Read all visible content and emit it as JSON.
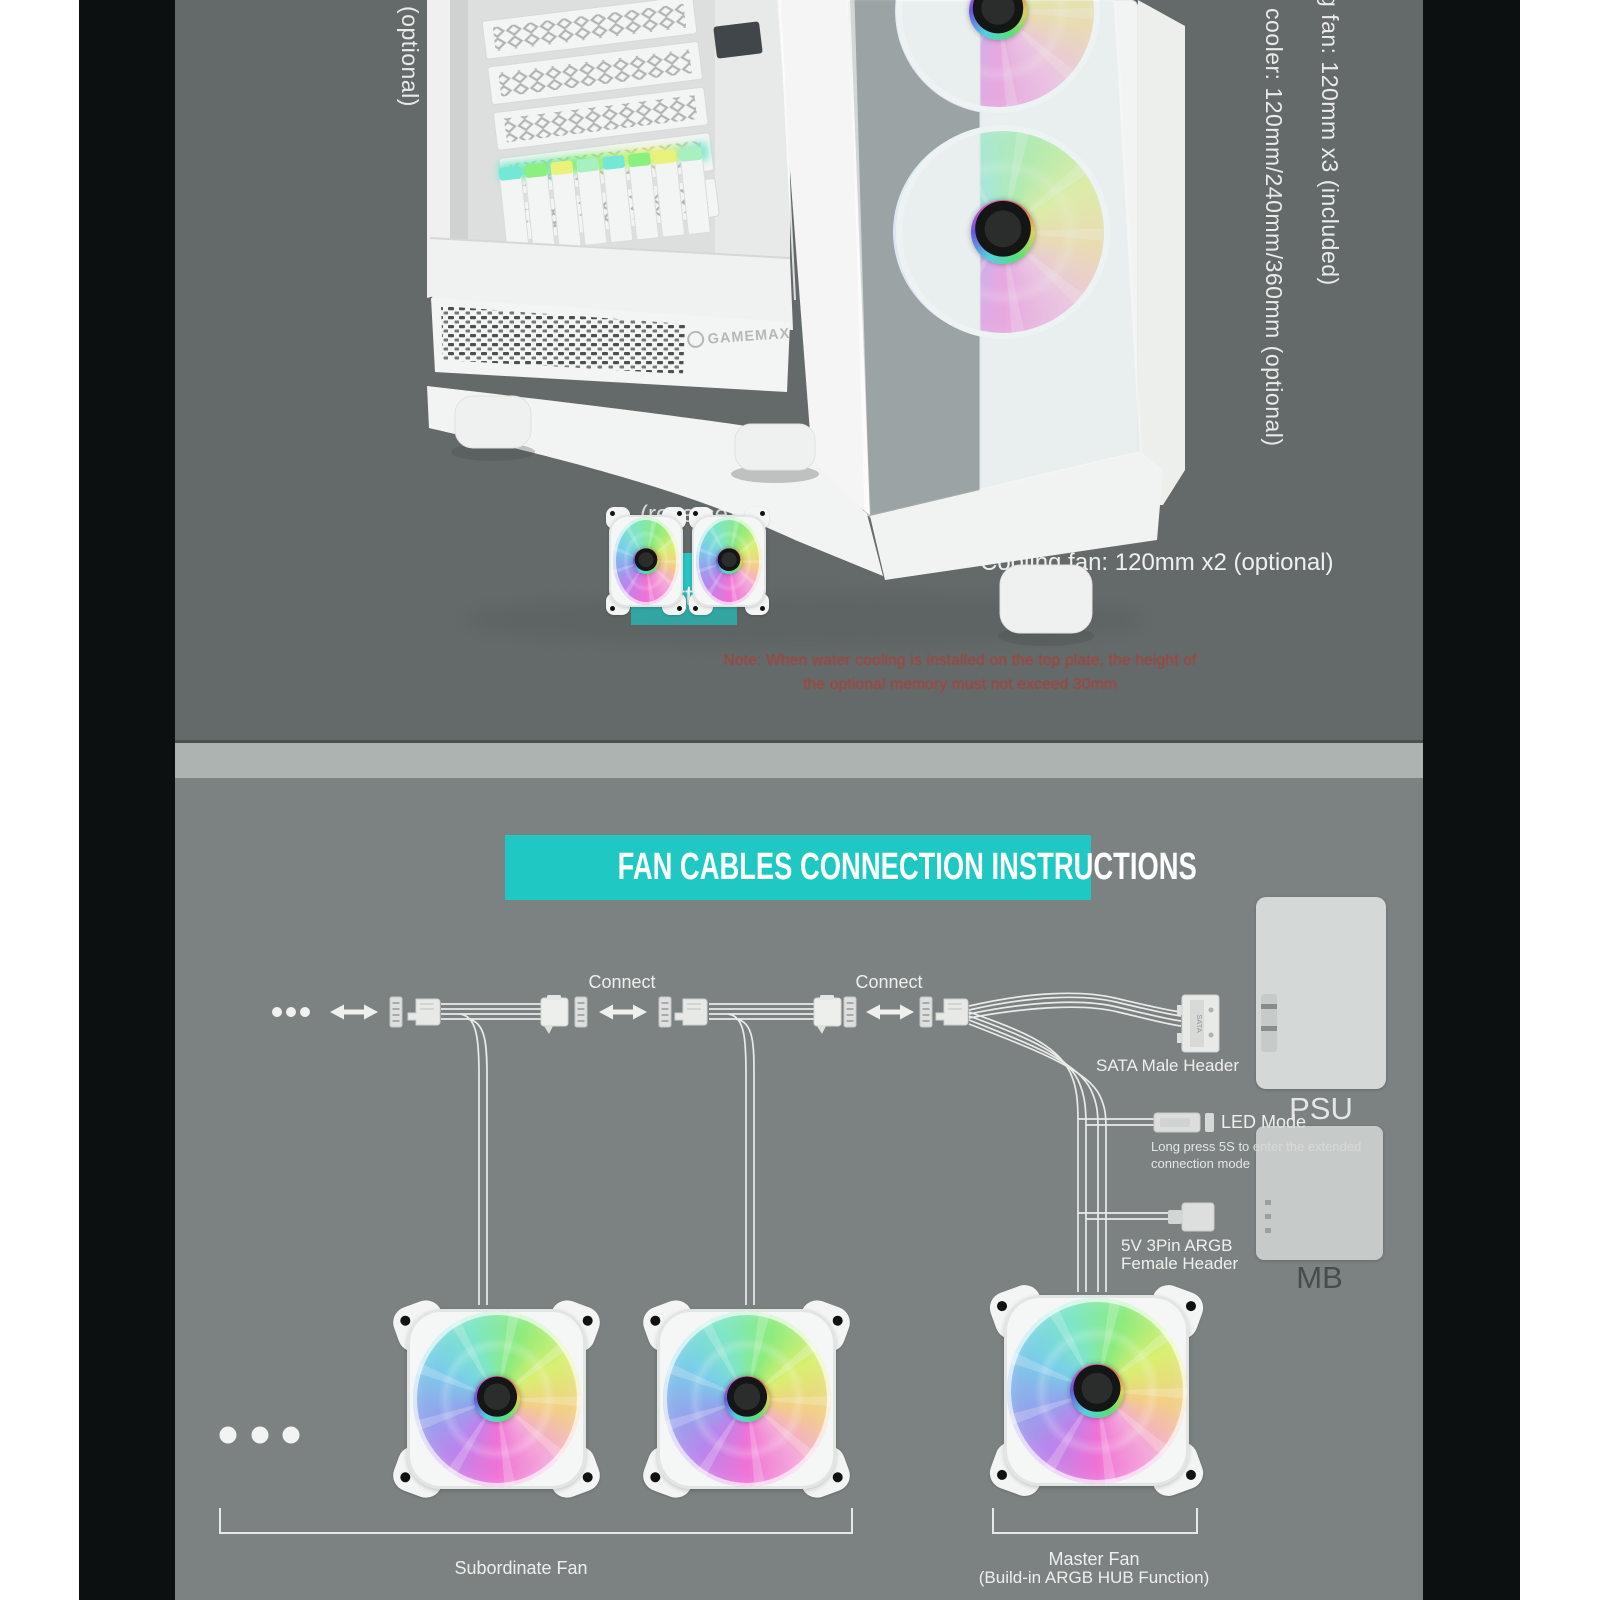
{
  "colors": {
    "page_margin": "#ffffff",
    "side_bar": "#0d1011",
    "top_bg": "#646a6a",
    "divider": "#adb3b1",
    "bottom_bg": "#7b8281",
    "teal_title": "#1fc8c2",
    "teal_chip": "#28c5c3",
    "text_light": "#edefee",
    "warning_red": "#b03a31",
    "box_gray": "#d4d8d6",
    "wire": "#e9ebe9"
  },
  "top_section": {
    "rotated_left_col1": "x1 (included)",
    "rotated_left_col2": "(optional)",
    "rotated_right_col1": "g fan: 120mm x3 (included)",
    "rotated_right_col2": "cooler: 120mm/240mm/360mm (optional)",
    "reverse_label": "(reverse)",
    "bottom_chip_label": "Bottom",
    "cooling_fan_text": "Cooling fan: 120mm x2 (optional)",
    "warning_line1": "Note: When water cooling is installed on the top plate, the height of",
    "warning_line2": "the optional memory must not exceed 30mm",
    "case_brand": "GAMEMAX"
  },
  "diagram": {
    "title": "FAN CABLES CONNECTION INSTRUCTIONS",
    "connect_label_left": "Connect",
    "connect_label_right": "Connect",
    "sata_icon_text": "SATA",
    "sata_label": "SATA Male Header",
    "psu_label": "PSU",
    "led_mode_label": "LED Mode",
    "long_press_line1": "Long press 5S to enter the extended",
    "long_press_line2": "connection mode",
    "argb_label_line1": "5V 3Pin ARGB",
    "argb_label_line2": "Female Header",
    "mb_label": "MB",
    "subordinate_fan_label": "Subordinate Fan",
    "master_fan_label_line1": "Master Fan",
    "master_fan_label_line2": "(Build-in ARGB HUB Function)"
  }
}
